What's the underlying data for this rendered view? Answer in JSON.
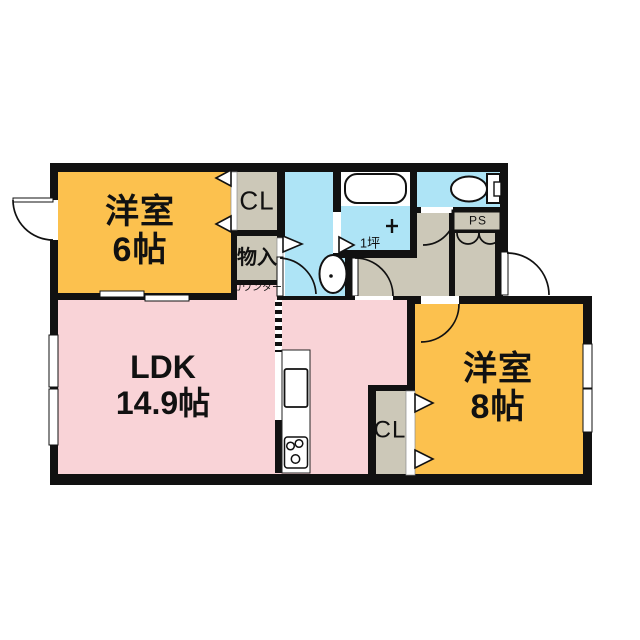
{
  "rooms": {
    "western6": {
      "name": "洋室",
      "size": "6帖"
    },
    "ldk": {
      "name": "LDK",
      "size": "14.9帖"
    },
    "western8": {
      "name": "洋室",
      "size": "8帖"
    },
    "closet_north": {
      "label": "CL"
    },
    "storage": {
      "label": "物入"
    },
    "counter": {
      "label": "カウンター"
    },
    "bath": {
      "size_label": "1坪"
    },
    "pipe_space": {
      "label": "PS"
    },
    "closet_south": {
      "label": "CL"
    }
  },
  "colors": {
    "wall": "#111111",
    "western_room_fill": "#fcc14e",
    "ldk_fill": "#f9d3d7",
    "wet_area_fill": "#aee4f6",
    "closet_fill": "#ccc8b8"
  },
  "fixtures": {
    "bathtub": "bathtub",
    "bath_faucet": "bath-faucet",
    "washbasin": "washbasin",
    "toilet": "toilet",
    "kitchen_counter": "kitchen-counter",
    "kitchen_sink": "kitchen-sink",
    "gas_stove": "gas-stove"
  }
}
